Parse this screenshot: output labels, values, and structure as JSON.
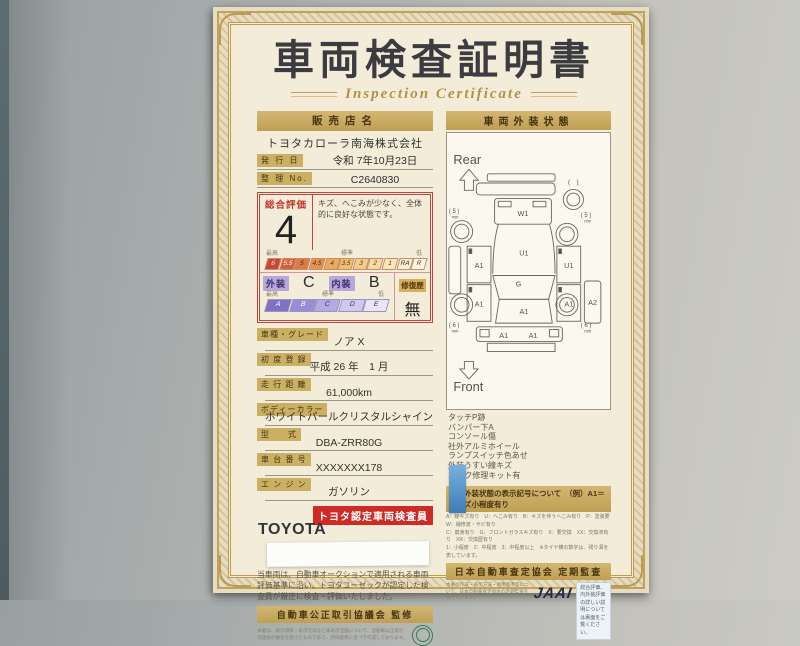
{
  "certificate": {
    "title": "車両検査証明書",
    "subtitle": "Inspection Certificate"
  },
  "left": {
    "dealer_header": "販売店名",
    "dealer_name": "トヨタカローラ南海株式会社",
    "issue_label": "発 行 日",
    "issue_value": "令和 7年10月23日",
    "ref_label": "整 理 No.",
    "ref_value": "C2640830",
    "rating": {
      "overall_label": "総合評価",
      "overall_value": "4",
      "comment": "キズ、へこみが少なく、全体的に良好な状態です。",
      "scale_top_left": "最高",
      "scale_top_mid": "標準",
      "scale_top_right": "低",
      "scale_cells": [
        "6",
        "5.5",
        "5",
        "4.5",
        "4",
        "3.5",
        "3",
        "2",
        "1",
        "RA",
        "R"
      ],
      "exterior_label": "外装",
      "exterior_value": "C",
      "interior_label": "内装",
      "interior_value": "B",
      "repair_label": "修復歴",
      "repair_value": "無",
      "grade_top_left": "最高",
      "grade_top_mid": "標準",
      "grade_top_right": "低",
      "grade_cells": [
        "A",
        "B",
        "C",
        "D",
        "E"
      ]
    },
    "fields": [
      {
        "label": "車種・グレード",
        "value": "ノア X"
      },
      {
        "label": "初 度 登 録",
        "value": "平成 26 年　1 月"
      },
      {
        "label": "走 行 距 離",
        "value": "61,000km"
      },
      {
        "label": "ボディーカラー",
        "value": "ホワイトパールクリスタルシャイン"
      },
      {
        "label": "型　　式",
        "value": "DBA-ZRR80G"
      },
      {
        "label": "車 台 番 号",
        "value": "XXXXXXX178"
      },
      {
        "label": "エ ン ジ ン",
        "value": "ガソリン"
      }
    ],
    "inspector_badge": "トヨタ認定車両検査員",
    "brand": "TOYOTA",
    "disclaimer": "当車両は、自動車オークションで適用される車両評価基準に沿い、トヨタユーゼックが認定した検査員が厳正に検査・評価いたしました。",
    "fair_trade_banner": "自動車公正取引協議会 監修",
    "fair_trade_note": "本書は、表示項目・表示方法など本表示全般について、自動車公正取引協議会の審査を受けたものであり、評価基準に基づき作成しております。"
  },
  "right": {
    "header": "車両外装状態",
    "diagram": {
      "rear_label": "Rear",
      "front_label": "Front",
      "spare_label": "(　)",
      "tire_unit": "mm",
      "tires": {
        "rear_left": "( 5 )",
        "rear_right": "( 5 )",
        "front_left": "( 6 )",
        "front_right": "( 6 )"
      },
      "markers": {
        "rear_gate": "W1",
        "cargo": "U1",
        "left_rear_door": "A1",
        "right_rear_door": "U1",
        "left_front_door": "A1",
        "right_front_door": "A1",
        "right_side": "A2",
        "glass": "G",
        "hood": "A1",
        "front_bumper_left": "A1",
        "front_bumper_right": "A1"
      }
    },
    "notes": [
      "タッチP跡",
      "バンパー下A",
      "コンソール傷",
      "社外アルミホイール",
      "ランプスイッチ色あせ",
      "外装うすい線キズ",
      "パンク修理キット有"
    ],
    "legend_header": "車両外装状態の表示記号について　（例）A1＝線キズ小程度有り",
    "legend_lines": [
      "A：線キズ有り　U：へこみ有り　B：キズを伴うへこみ有り　P：塗装要　W：補修波・サビ有り",
      "C：腐食有り　G：フロントガラスキズ有り　X：要交換　XX：交換済有り　XR：交換歴有り",
      "1：小程度　2：中程度　3：中程度以上　※タイヤ横の数字は、残り溝を表しています。"
    ],
    "assessor_banner": "日本自動車査定協会 定期監査",
    "assessor_note": "本書の作成・表示方法・適用基準等について、日本自動車査定協会の定期監査を受けています。",
    "jaai_logo": "JAAI",
    "back_note": "総合評価、内外装評価の詳しい説明については裏面をご覧ください。"
  }
}
